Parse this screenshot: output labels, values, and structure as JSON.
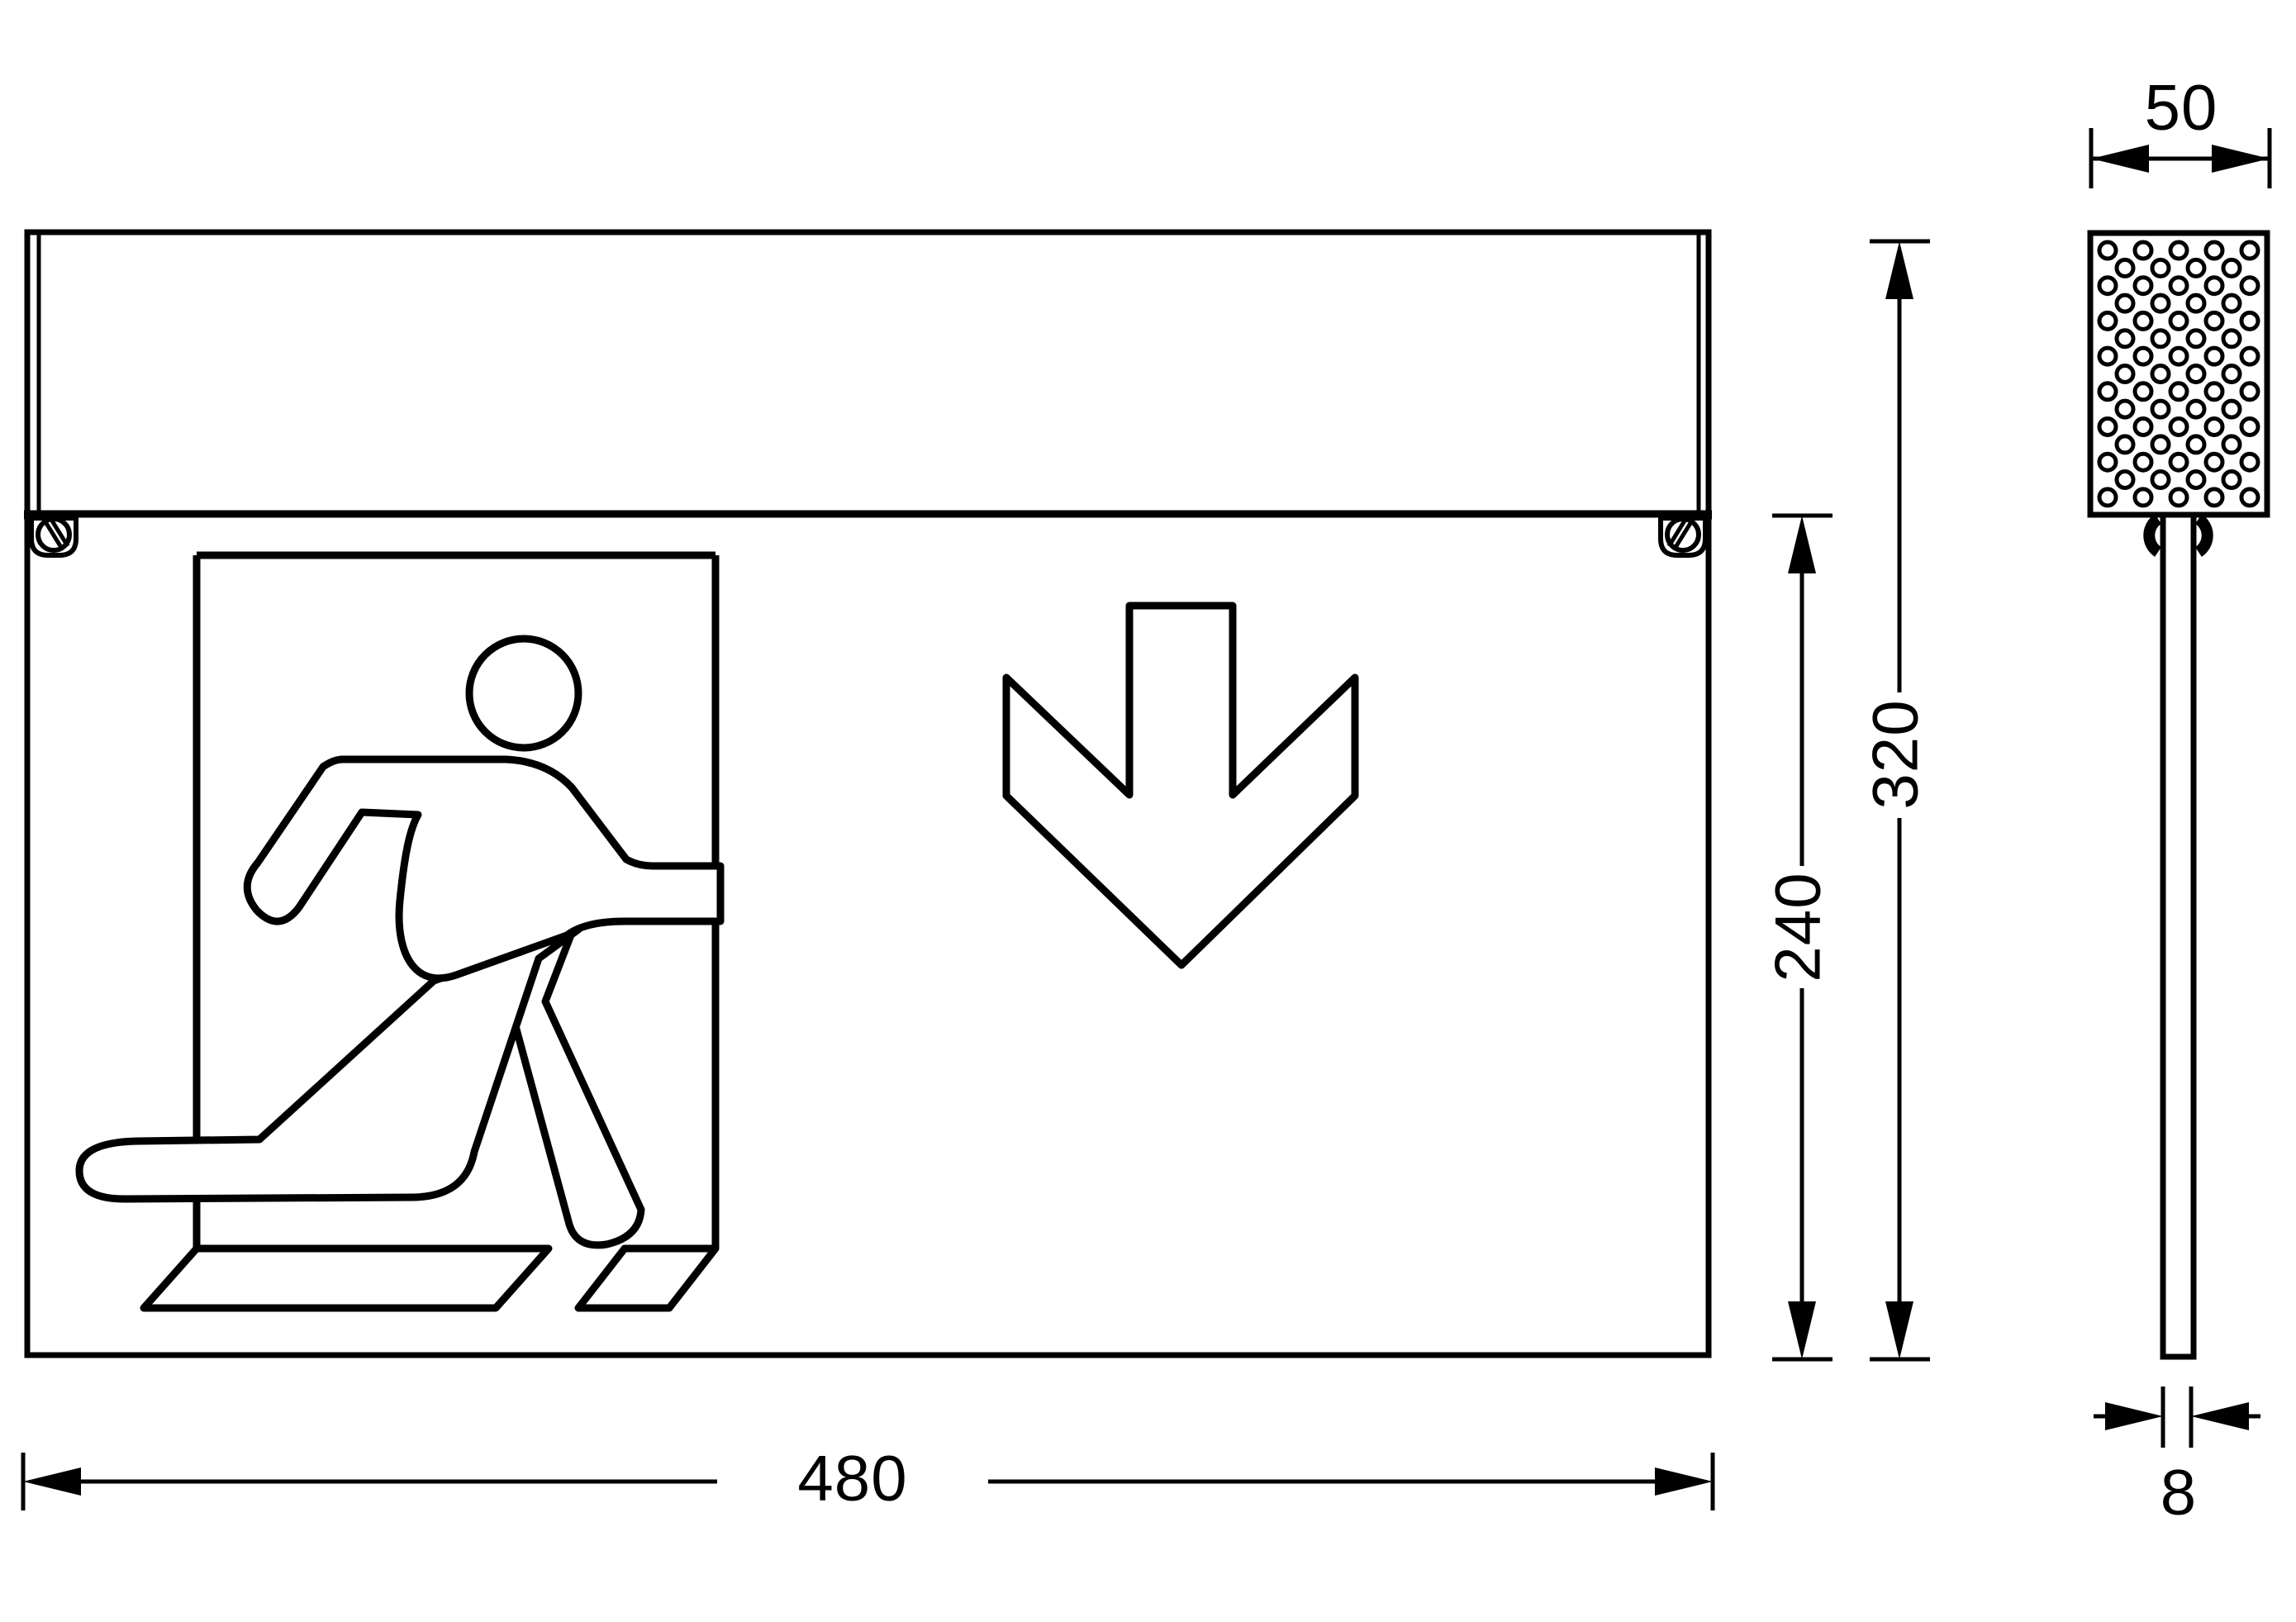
{
  "page": {
    "background": "#ffffff",
    "line_color": "#000000",
    "description": "Technical dimension drawing of an emergency exit sign luminaire"
  },
  "views": {
    "front": {
      "name": "front-view"
    },
    "side": {
      "name": "side-view"
    }
  },
  "symbols": {
    "pictogram": "running-man-exit",
    "direction_arrow": "down"
  },
  "dimensions": {
    "width": {
      "value": "480",
      "orientation": "horizontal"
    },
    "total_height": {
      "value": "320",
      "orientation": "vertical"
    },
    "panel_height": {
      "value": "240",
      "orientation": "vertical"
    },
    "housing_depth": {
      "value": "50",
      "orientation": "horizontal"
    },
    "panel_thickness": {
      "value": "8",
      "orientation": "horizontal"
    }
  }
}
